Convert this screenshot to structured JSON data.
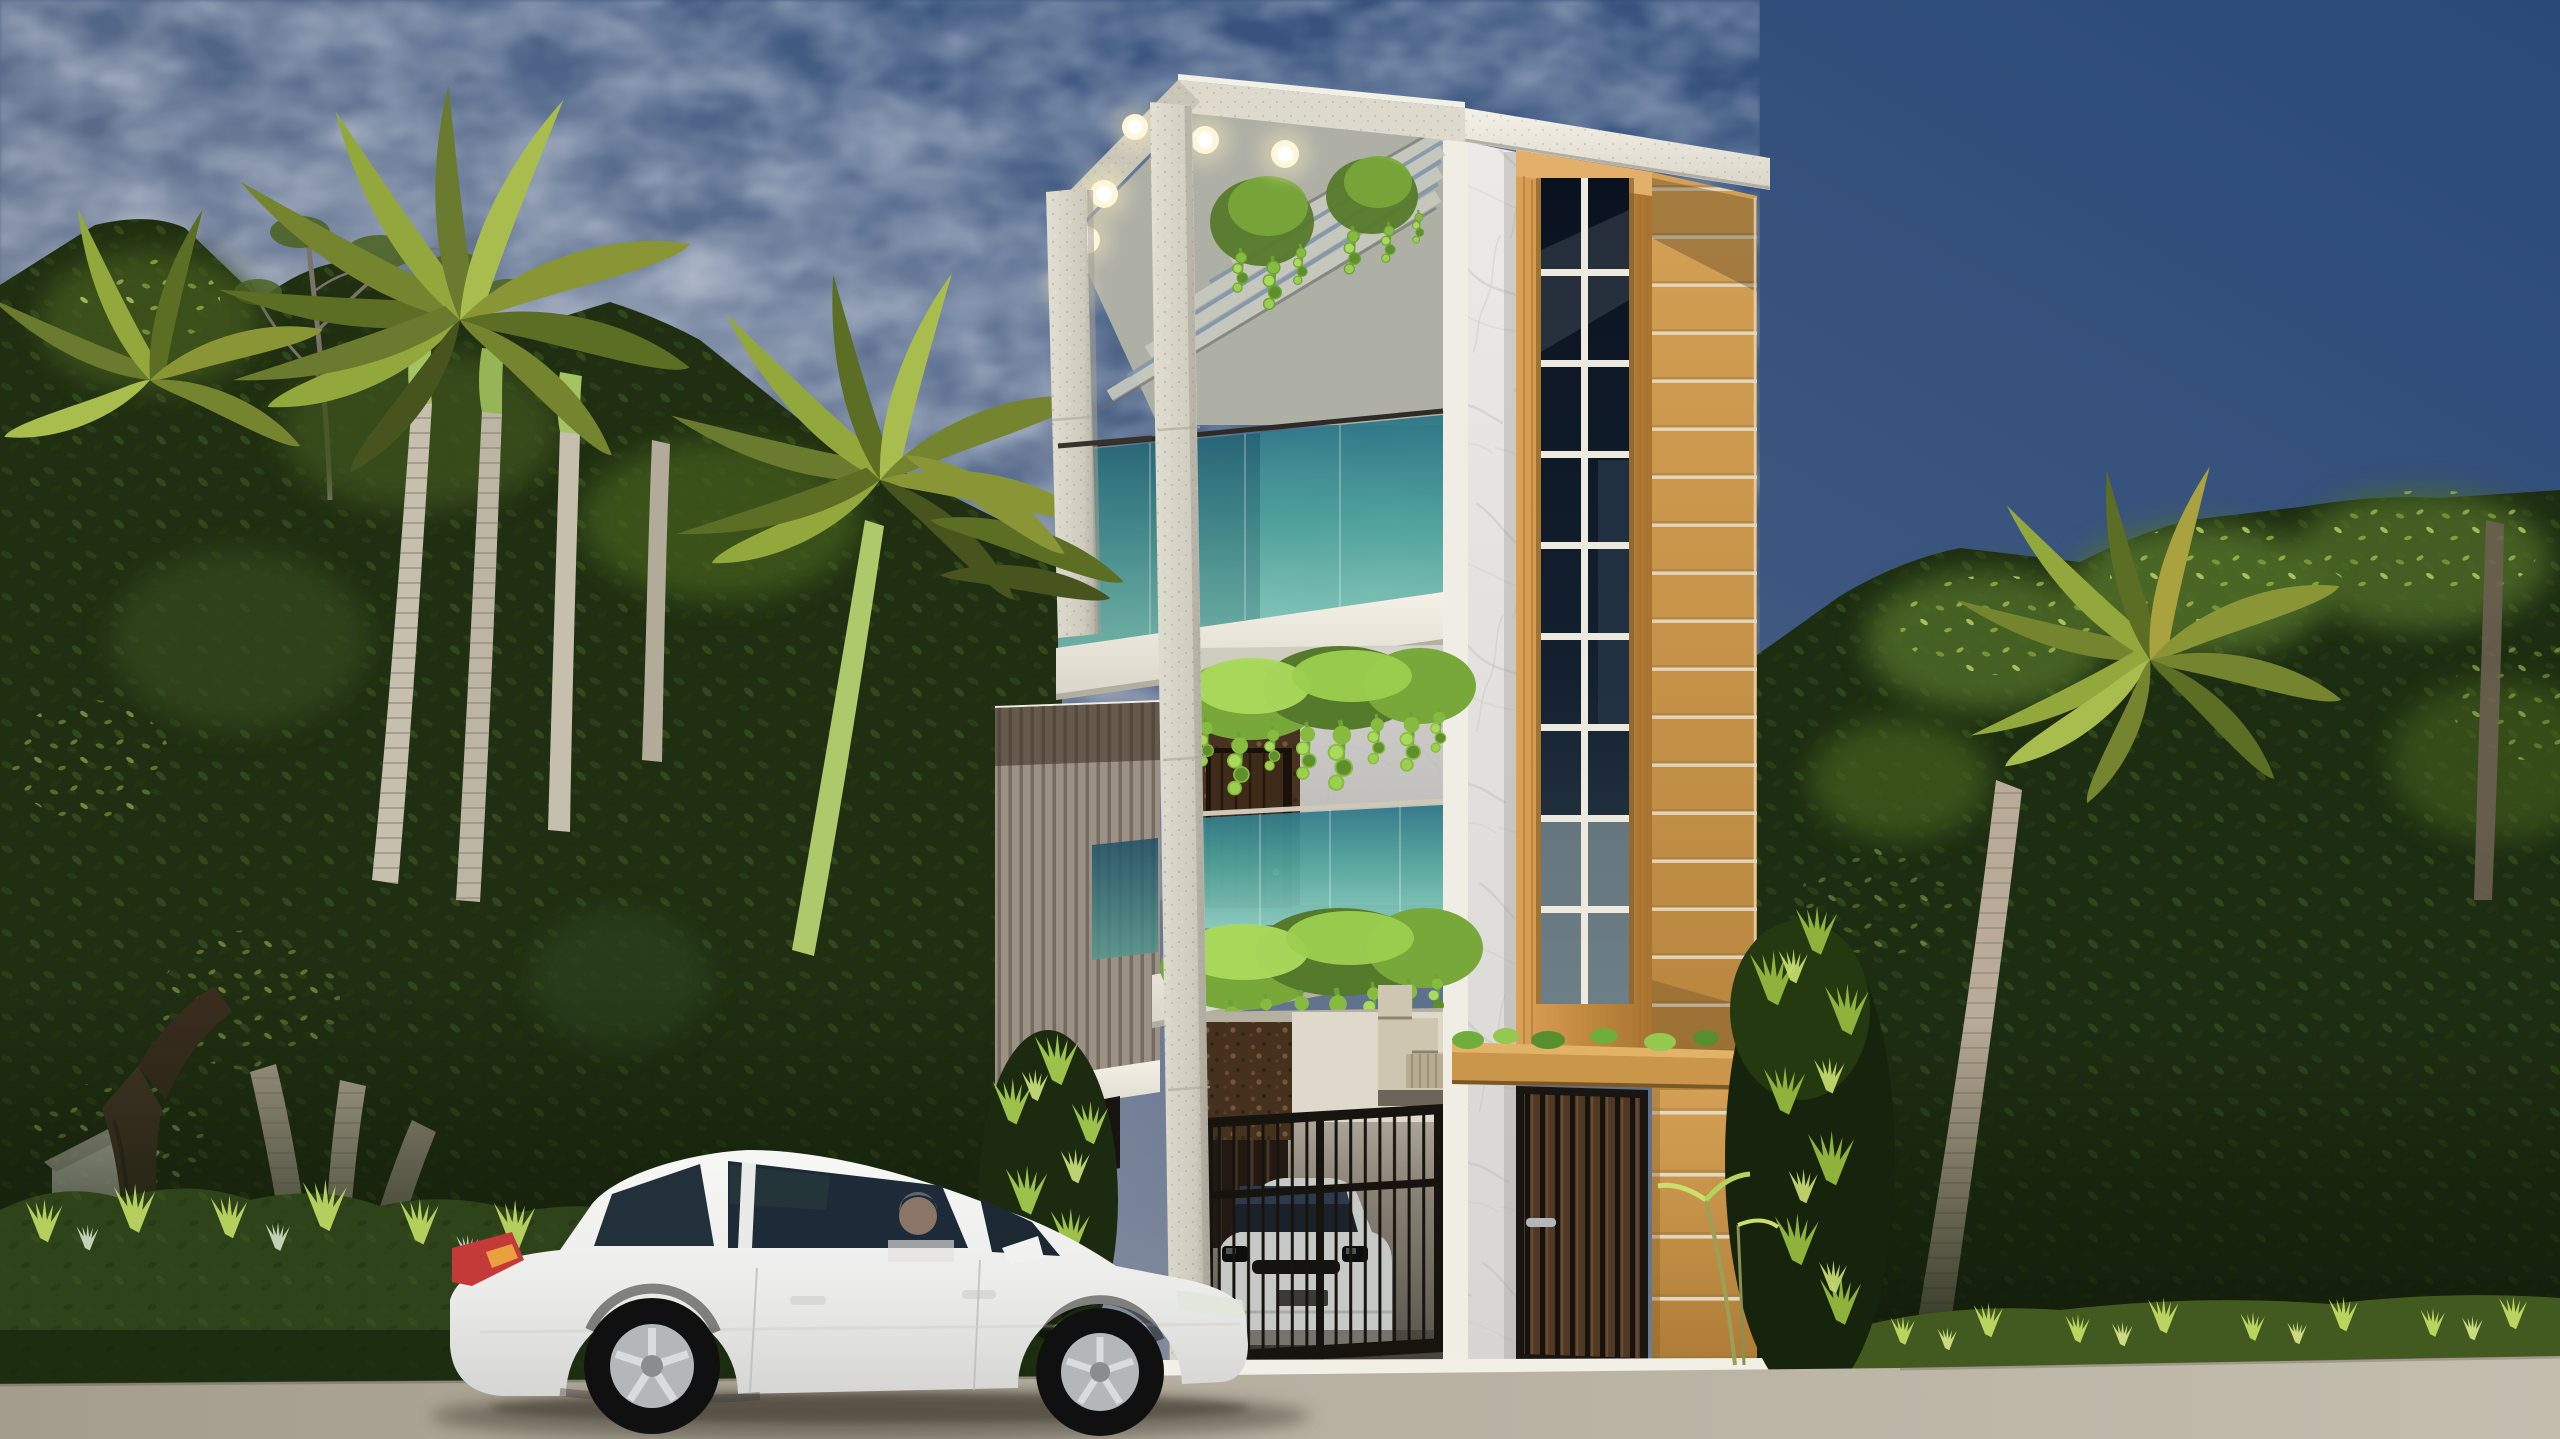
{
  "scene": {
    "title": "Photorealistic dusk render of a narrow modern three-storey house with palms and a white sedan",
    "description": "Architectural visualization at dusk: a slim three-storey modern villa with a white concrete pergola frame with warm recessed lights, teal glass balconies with hanging vines, a white marble pier, a tall oak-framed gridded window column, mustard horizontal-siding wall, black vertical-bar garage gate with a silver car parked inside, slatted wood entry door under an oak canopy. Dense tropical trees and coconut palms flank both sides, a sunlit hedge and grass strip line the road, and a white sedan with an elderly driver is parked in front.",
    "time_of_day": "dusk",
    "weather": "clear with wispy clouds on the left sky"
  },
  "palette": {
    "sky_deep_blue": "#2a4979",
    "sky_mid": "#64748f",
    "sky_pale": "#a8adb6",
    "cloud_white": "#ffffff",
    "concrete_light": "#dedbd0",
    "concrete_shade": "#c2bfb2",
    "slab_white": "#f2efe6",
    "marble_white": "#eceae6",
    "marble_vein": "#b4b7bd",
    "teal_glass_top": "#2d7587",
    "teal_glass_mid": "#4ea39c",
    "teal_glass_light": "#8fd0c0",
    "oak_frame": "#c9964a",
    "oak_light": "#e0ab62",
    "tan_siding": "#c59148",
    "siding_joint": "#e2d8c2",
    "window_glass_dark": "#0a1220",
    "window_muntin": "#eceade",
    "cork_brown": "#483323",
    "walnut_door": "#3f2b1a",
    "entry_slat": "#503824",
    "gate_black": "#17140f",
    "vine_green": "#86bb3f",
    "vine_light": "#aada5c",
    "foliage_dark": "#1f2f12",
    "foliage_mid": "#4e6a26",
    "foliage_lime": "#c6dd6f",
    "palm_olive": "#75842f",
    "palm_lit": "#a9bc4e",
    "trunk_gray": "#c6bfae",
    "trunk_ring": "#8f887a",
    "crownshaft_green": "#a4c363",
    "hedge_base": "#2e431a",
    "road_gray": "#b6afa0",
    "shadow_warm": "#4a4439",
    "car_white": "#f7f7f5",
    "car_shade": "#d5d5d3",
    "car_glass": "#22303c",
    "tail_light_red": "#c43a38",
    "rim_silver": "#b4b7ba",
    "driver_skin": "#c9a284",
    "driver_hair": "#8e8d8b",
    "parked_car_silver": "#c7c9c6",
    "pergola_light_glow": "#fff1bf"
  },
  "building": {
    "floors": 3,
    "pergola": {
      "material": "white speckled concrete",
      "recessed_lights_count": 6,
      "light_color": "#fff1bf",
      "vines_on_slats": true
    },
    "top_terrace": {
      "railing": "frameless teal glass",
      "hanging_vines": true
    },
    "middle_balcony": {
      "railing": "teal glass",
      "back_wall": "dark cork stone",
      "door": "walnut plank door",
      "hanging_vines": true
    },
    "window_column": {
      "frame": "oak wood",
      "grid_cols": 2,
      "grid_rows": 9,
      "glass": "dark reflective"
    },
    "tan_wall": {
      "finish": "mustard horizontal siding",
      "joint_spacing_px": 48
    },
    "marble_pier": {
      "finish": "white carrara-style marble with gray veins"
    },
    "ground_floor": {
      "gate": "black vertical-bar car gate",
      "vehicle_inside": "silver sedan facing out",
      "staircase_visible": true,
      "entry_door": "vertical wood-slat door with steel handle",
      "canopy": "oak slab canopy with potted greens on top",
      "brick_pillar": "tan pillar with light horizontal joints",
      "plinth": "white marble base strip"
    },
    "left_annex": {
      "finish": "taupe vertical slat cladding",
      "louvre_window": true
    }
  },
  "vegetation": {
    "left": [
      "dense tropical canopy",
      "coconut palm cluster with green crownshafts",
      "bare twiggy tree",
      "forked gnarled trunk",
      "sunlit hedge row"
    ],
    "right": [
      "dense leafy wall with lime highlights",
      "arching olive palm crown",
      "ringed palm trunk",
      "grass strip"
    ],
    "near_building": [
      "bamboo palm tuft left of gate",
      "fern shrub at right corner",
      "thin sapling before tan pillar"
    ]
  },
  "street": {
    "surface": "warm gray asphalt-concrete",
    "car_shadow": true,
    "hedge_shadow_line": true
  },
  "car": {
    "type": "white mid-size sedan",
    "facing": "right",
    "driver": "elderly man with gray hair in white shirt",
    "wheels": "5-spoke silver alloys",
    "tail_light": "red with amber insert",
    "door_count_visible": 2
  },
  "background": {
    "white_house_glimpse_far_left": true
  }
}
